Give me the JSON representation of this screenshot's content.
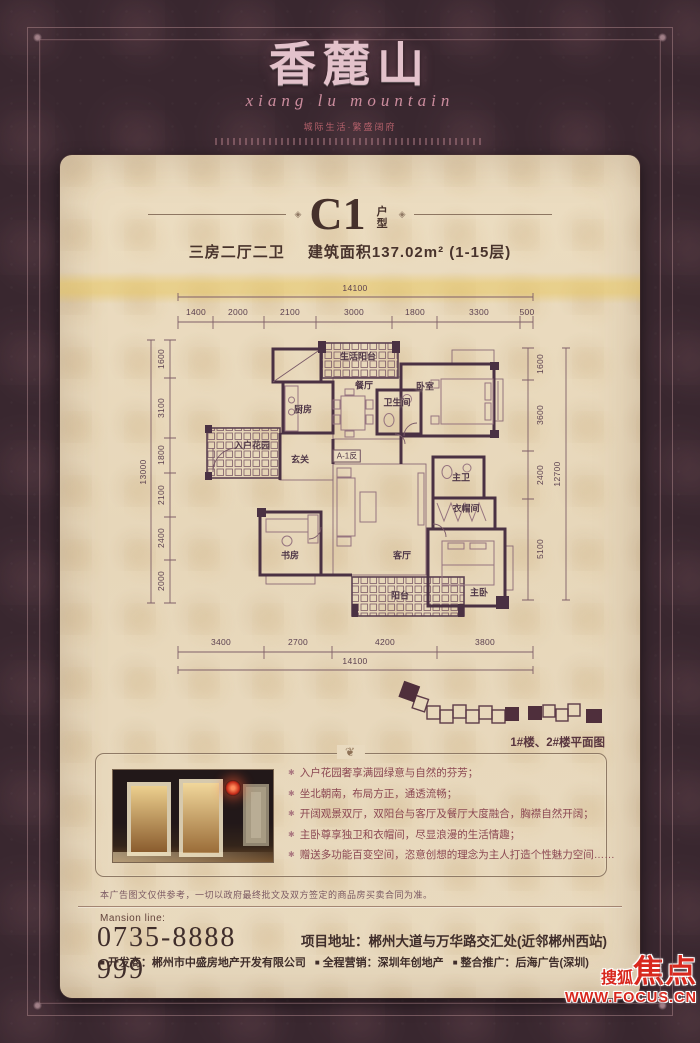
{
  "brand": {
    "logo": "香麓山",
    "script": "xiang lu mountain",
    "tagline": "城际生活·繁盛阔府"
  },
  "unit": {
    "code": "C1",
    "type_label": "户型",
    "spec": "三房二厅二卫",
    "area_floors": "建筑面积137.02m² (1-15层)"
  },
  "floorplan": {
    "dims_top": {
      "total": "14100",
      "segments": [
        "1400",
        "2000",
        "2100",
        "3000",
        "1800",
        "3300",
        "500"
      ]
    },
    "dims_bottom": {
      "total": "14100",
      "segments": [
        "3400",
        "2700",
        "4200",
        "3800"
      ]
    },
    "dims_left": {
      "total": "13000",
      "segments": [
        "1600",
        "3100",
        "1800",
        "2100",
        "2400",
        "2000"
      ]
    },
    "dims_right": {
      "total": "12700",
      "segments": [
        "1600",
        "3600",
        "2400",
        "5100"
      ]
    },
    "rooms": [
      "生活阳台",
      "餐厅",
      "厨房",
      "卫生间",
      "卧室",
      "入户花园",
      "玄关",
      "主卫",
      "衣帽间",
      "书房",
      "客厅",
      "阳台",
      "主卧"
    ],
    "unit_tag": "A-1反"
  },
  "keyplan": {
    "caption": "1#楼、2#楼平面图"
  },
  "features": {
    "bullets": [
      "入户花园奢享满园绿意与自然的芬芳；",
      "坐北朝南，布局方正，通透流畅；",
      "开阔观景双厅，双阳台与客厅及餐厅大度融合，胸襟自然开阔；",
      "主卧尊享独卫和衣帽间，尽显浪漫的生活情趣；",
      "赠送多功能百变空间，恣意创想的理念为主人打造个性魅力空间……"
    ]
  },
  "disclaimer": "本广告图文仅供参考，一切以政府最终批文及双方签定的商品房买卖合同为准。",
  "contact": {
    "line_label": "Mansion line:",
    "phone": "0735-8888 999",
    "address": "项目地址：郴州大道与万华路交汇处(近邻郴州西站)",
    "credits": [
      "开发商：郴州市中盛房地产开发有限公司",
      "全程营销：深圳年创地产",
      "整合推广：后海广告(深圳)"
    ]
  },
  "watermark": {
    "brand_small": "搜狐",
    "brand_big": "焦点",
    "site": "WWW.FOCUS.CN"
  }
}
